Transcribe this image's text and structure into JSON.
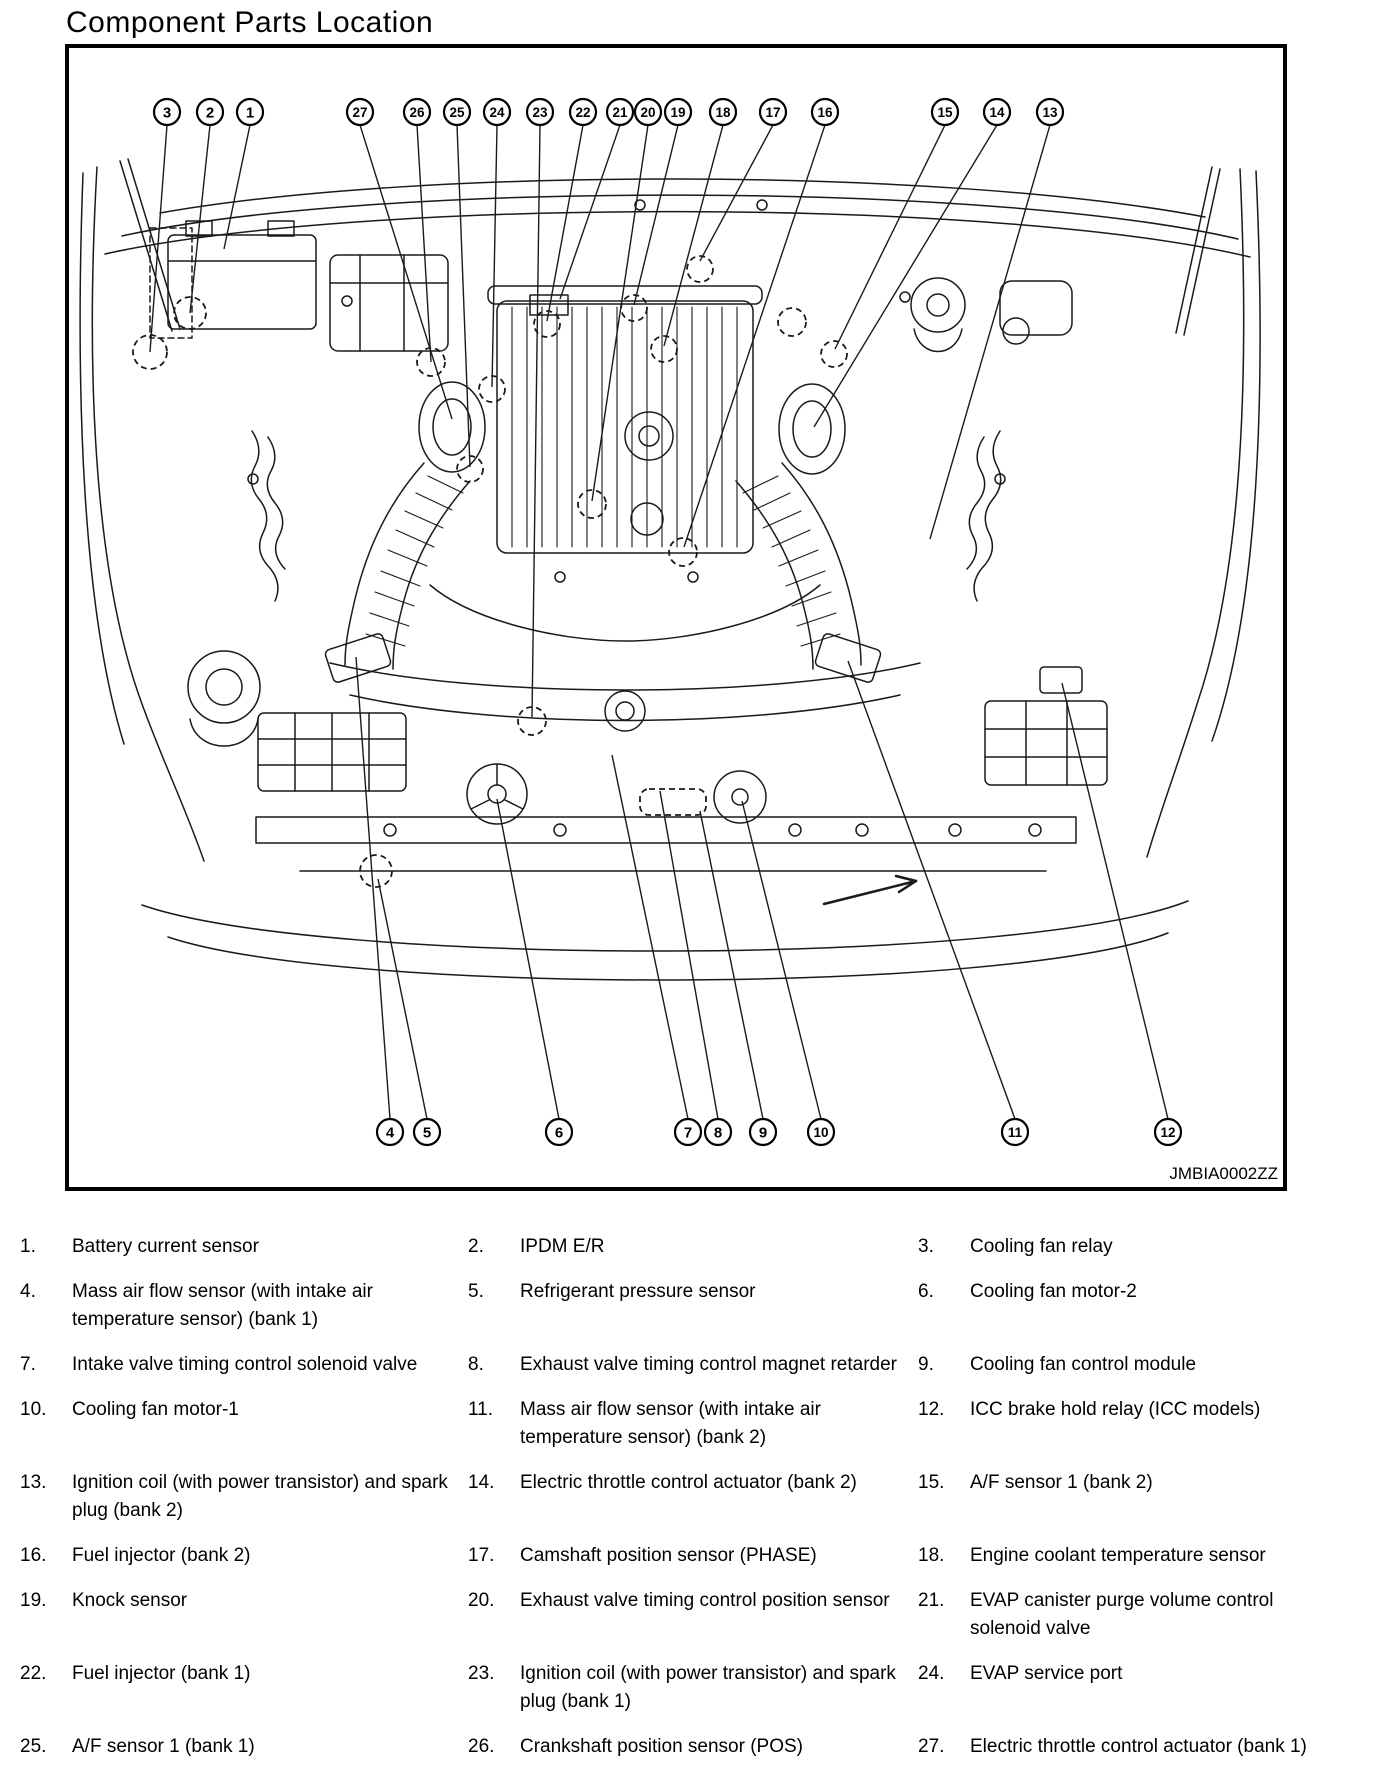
{
  "page": {
    "title": "Component Parts Location"
  },
  "figure": {
    "code": "JMBIA0002ZZ",
    "callouts_top": [
      {
        "n": "3",
        "x": 167,
        "y": 113,
        "tx": 150,
        "ty": 353
      },
      {
        "n": "2",
        "x": 210,
        "y": 113,
        "tx": 190,
        "ty": 314
      },
      {
        "n": "1",
        "x": 250,
        "y": 113,
        "tx": 224,
        "ty": 250
      },
      {
        "n": "27",
        "x": 360,
        "y": 113,
        "tx": 452,
        "ty": 420
      },
      {
        "n": "26",
        "x": 417,
        "y": 113,
        "tx": 431,
        "ty": 363
      },
      {
        "n": "25",
        "x": 457,
        "y": 113,
        "tx": 470,
        "ty": 468
      },
      {
        "n": "24",
        "x": 497,
        "y": 113,
        "tx": 492,
        "ty": 388
      },
      {
        "n": "23",
        "x": 540,
        "y": 113,
        "tx": 532,
        "ty": 718
      },
      {
        "n": "22",
        "x": 583,
        "y": 113,
        "tx": 547,
        "ty": 322
      },
      {
        "n": "21",
        "x": 620,
        "y": 113,
        "tx": 560,
        "ty": 300
      },
      {
        "n": "20",
        "x": 648,
        "y": 113,
        "tx": 592,
        "ty": 502
      },
      {
        "n": "19",
        "x": 678,
        "y": 113,
        "tx": 634,
        "ty": 306
      },
      {
        "n": "18",
        "x": 723,
        "y": 113,
        "tx": 664,
        "ty": 347
      },
      {
        "n": "17",
        "x": 773,
        "y": 113,
        "tx": 700,
        "ty": 262
      },
      {
        "n": "16",
        "x": 825,
        "y": 113,
        "tx": 684,
        "ty": 548
      },
      {
        "n": "15",
        "x": 945,
        "y": 113,
        "tx": 835,
        "ty": 350
      },
      {
        "n": "14",
        "x": 997,
        "y": 113,
        "tx": 814,
        "ty": 428
      },
      {
        "n": "13",
        "x": 1050,
        "y": 113,
        "tx": 930,
        "ty": 540
      }
    ],
    "callouts_bottom": [
      {
        "n": "4",
        "x": 390,
        "y": 1133,
        "tx": 356,
        "ty": 658
      },
      {
        "n": "5",
        "x": 427,
        "y": 1133,
        "tx": 378,
        "ty": 880
      },
      {
        "n": "6",
        "x": 559,
        "y": 1133,
        "tx": 497,
        "ty": 800
      },
      {
        "n": "7",
        "x": 688,
        "y": 1133,
        "tx": 612,
        "ty": 756
      },
      {
        "n": "8",
        "x": 718,
        "y": 1133,
        "tx": 660,
        "ty": 792
      },
      {
        "n": "9",
        "x": 763,
        "y": 1133,
        "tx": 700,
        "ty": 812
      },
      {
        "n": "10",
        "x": 821,
        "y": 1133,
        "tx": 742,
        "ty": 802
      },
      {
        "n": "11",
        "x": 1015,
        "y": 1133,
        "tx": 848,
        "ty": 662
      },
      {
        "n": "12",
        "x": 1168,
        "y": 1133,
        "tx": 1062,
        "ty": 684
      }
    ]
  },
  "legend": {
    "items": [
      {
        "n": "1.",
        "label": "Battery current sensor"
      },
      {
        "n": "2.",
        "label": "IPDM E/R"
      },
      {
        "n": "3.",
        "label": "Cooling fan relay"
      },
      {
        "n": "4.",
        "label": "Mass air flow sensor (with intake air temperature sensor) (bank 1)"
      },
      {
        "n": "5.",
        "label": "Refrigerant pressure sensor"
      },
      {
        "n": "6.",
        "label": "Cooling fan motor-2"
      },
      {
        "n": "7.",
        "label": "Intake valve timing control solenoid valve"
      },
      {
        "n": "8.",
        "label": "Exhaust valve timing control magnet retarder"
      },
      {
        "n": "9.",
        "label": "Cooling fan control module"
      },
      {
        "n": "10.",
        "label": "Cooling fan motor-1"
      },
      {
        "n": "11.",
        "label": "Mass air flow sensor (with intake air temperature sensor) (bank 2)"
      },
      {
        "n": "12.",
        "label": "ICC brake hold relay (ICC models)"
      },
      {
        "n": "13.",
        "label": "Ignition coil (with power transistor) and spark plug (bank 2)"
      },
      {
        "n": "14.",
        "label": "Electric throttle control actuator (bank 2)"
      },
      {
        "n": "15.",
        "label": "A/F sensor 1 (bank 2)"
      },
      {
        "n": "16.",
        "label": "Fuel injector (bank 2)"
      },
      {
        "n": "17.",
        "label": "Camshaft position sensor (PHASE)"
      },
      {
        "n": "18.",
        "label": "Engine coolant temperature sensor"
      },
      {
        "n": "19.",
        "label": "Knock sensor"
      },
      {
        "n": "20.",
        "label": "Exhaust valve timing control position sensor"
      },
      {
        "n": "21.",
        "label": "EVAP canister purge volume control solenoid valve"
      },
      {
        "n": "22.",
        "label": "Fuel injector (bank 1)"
      },
      {
        "n": "23.",
        "label": "Ignition coil (with power transistor) and spark plug (bank 1)"
      },
      {
        "n": "24.",
        "label": "EVAP service port"
      },
      {
        "n": "25.",
        "label": "A/F sensor 1 (bank 1)"
      },
      {
        "n": "26.",
        "label": "Crankshaft position sensor (POS)"
      },
      {
        "n": "27.",
        "label": "Electric throttle control actuator (bank 1)"
      }
    ]
  }
}
